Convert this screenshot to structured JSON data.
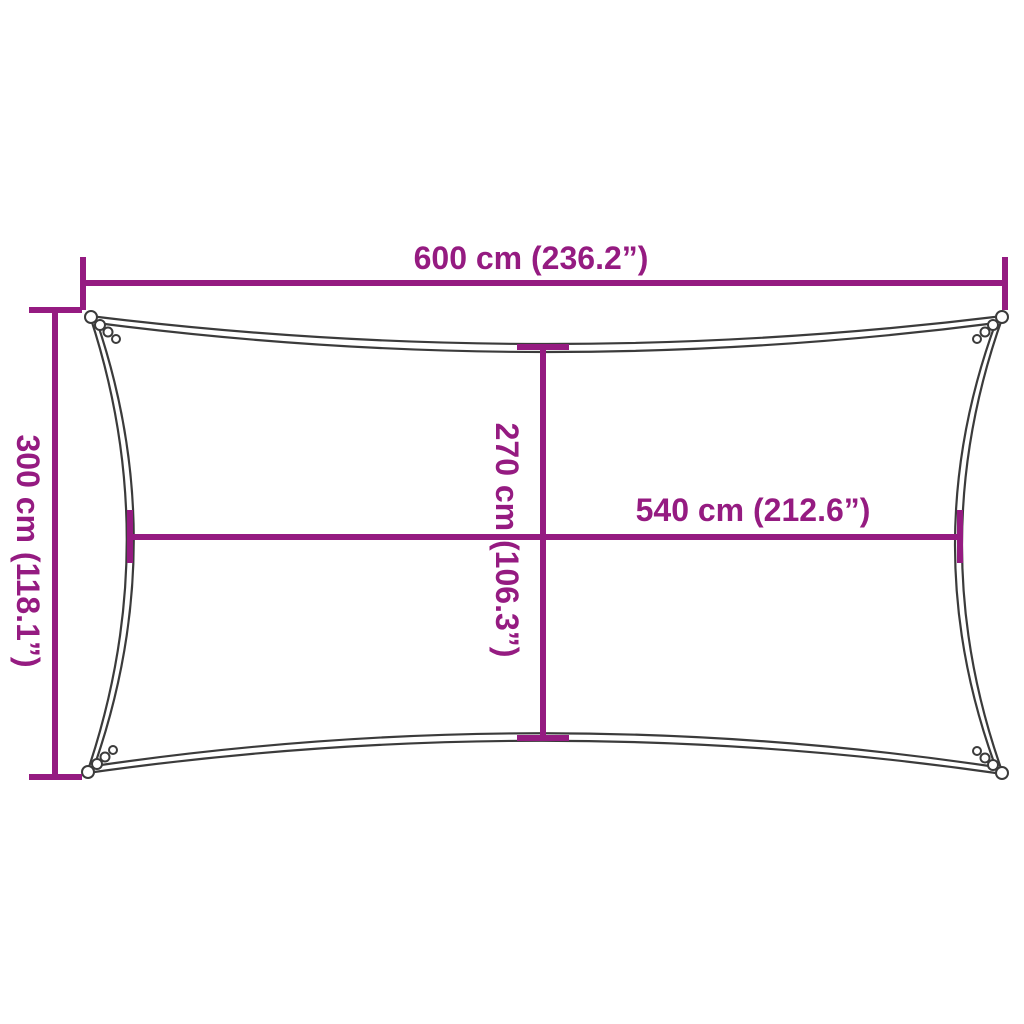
{
  "diagram": {
    "background": "#FFFFFF",
    "colors": {
      "dimension_accent": "#951B81",
      "sail_outline": "#3B3B3B"
    },
    "dimensions": {
      "top_width": {
        "label": "600 cm (236.2”)",
        "cm": 600,
        "inches": 236.2
      },
      "left_height": {
        "label": "300 cm (118.1”)",
        "cm": 300,
        "inches": 118.1
      },
      "inner_height": {
        "label": "270 cm (106.3”)",
        "cm": 270,
        "inches": 106.3
      },
      "inner_width": {
        "label": "540 cm (212.6”)",
        "cm": 540,
        "inches": 212.6
      }
    }
  }
}
